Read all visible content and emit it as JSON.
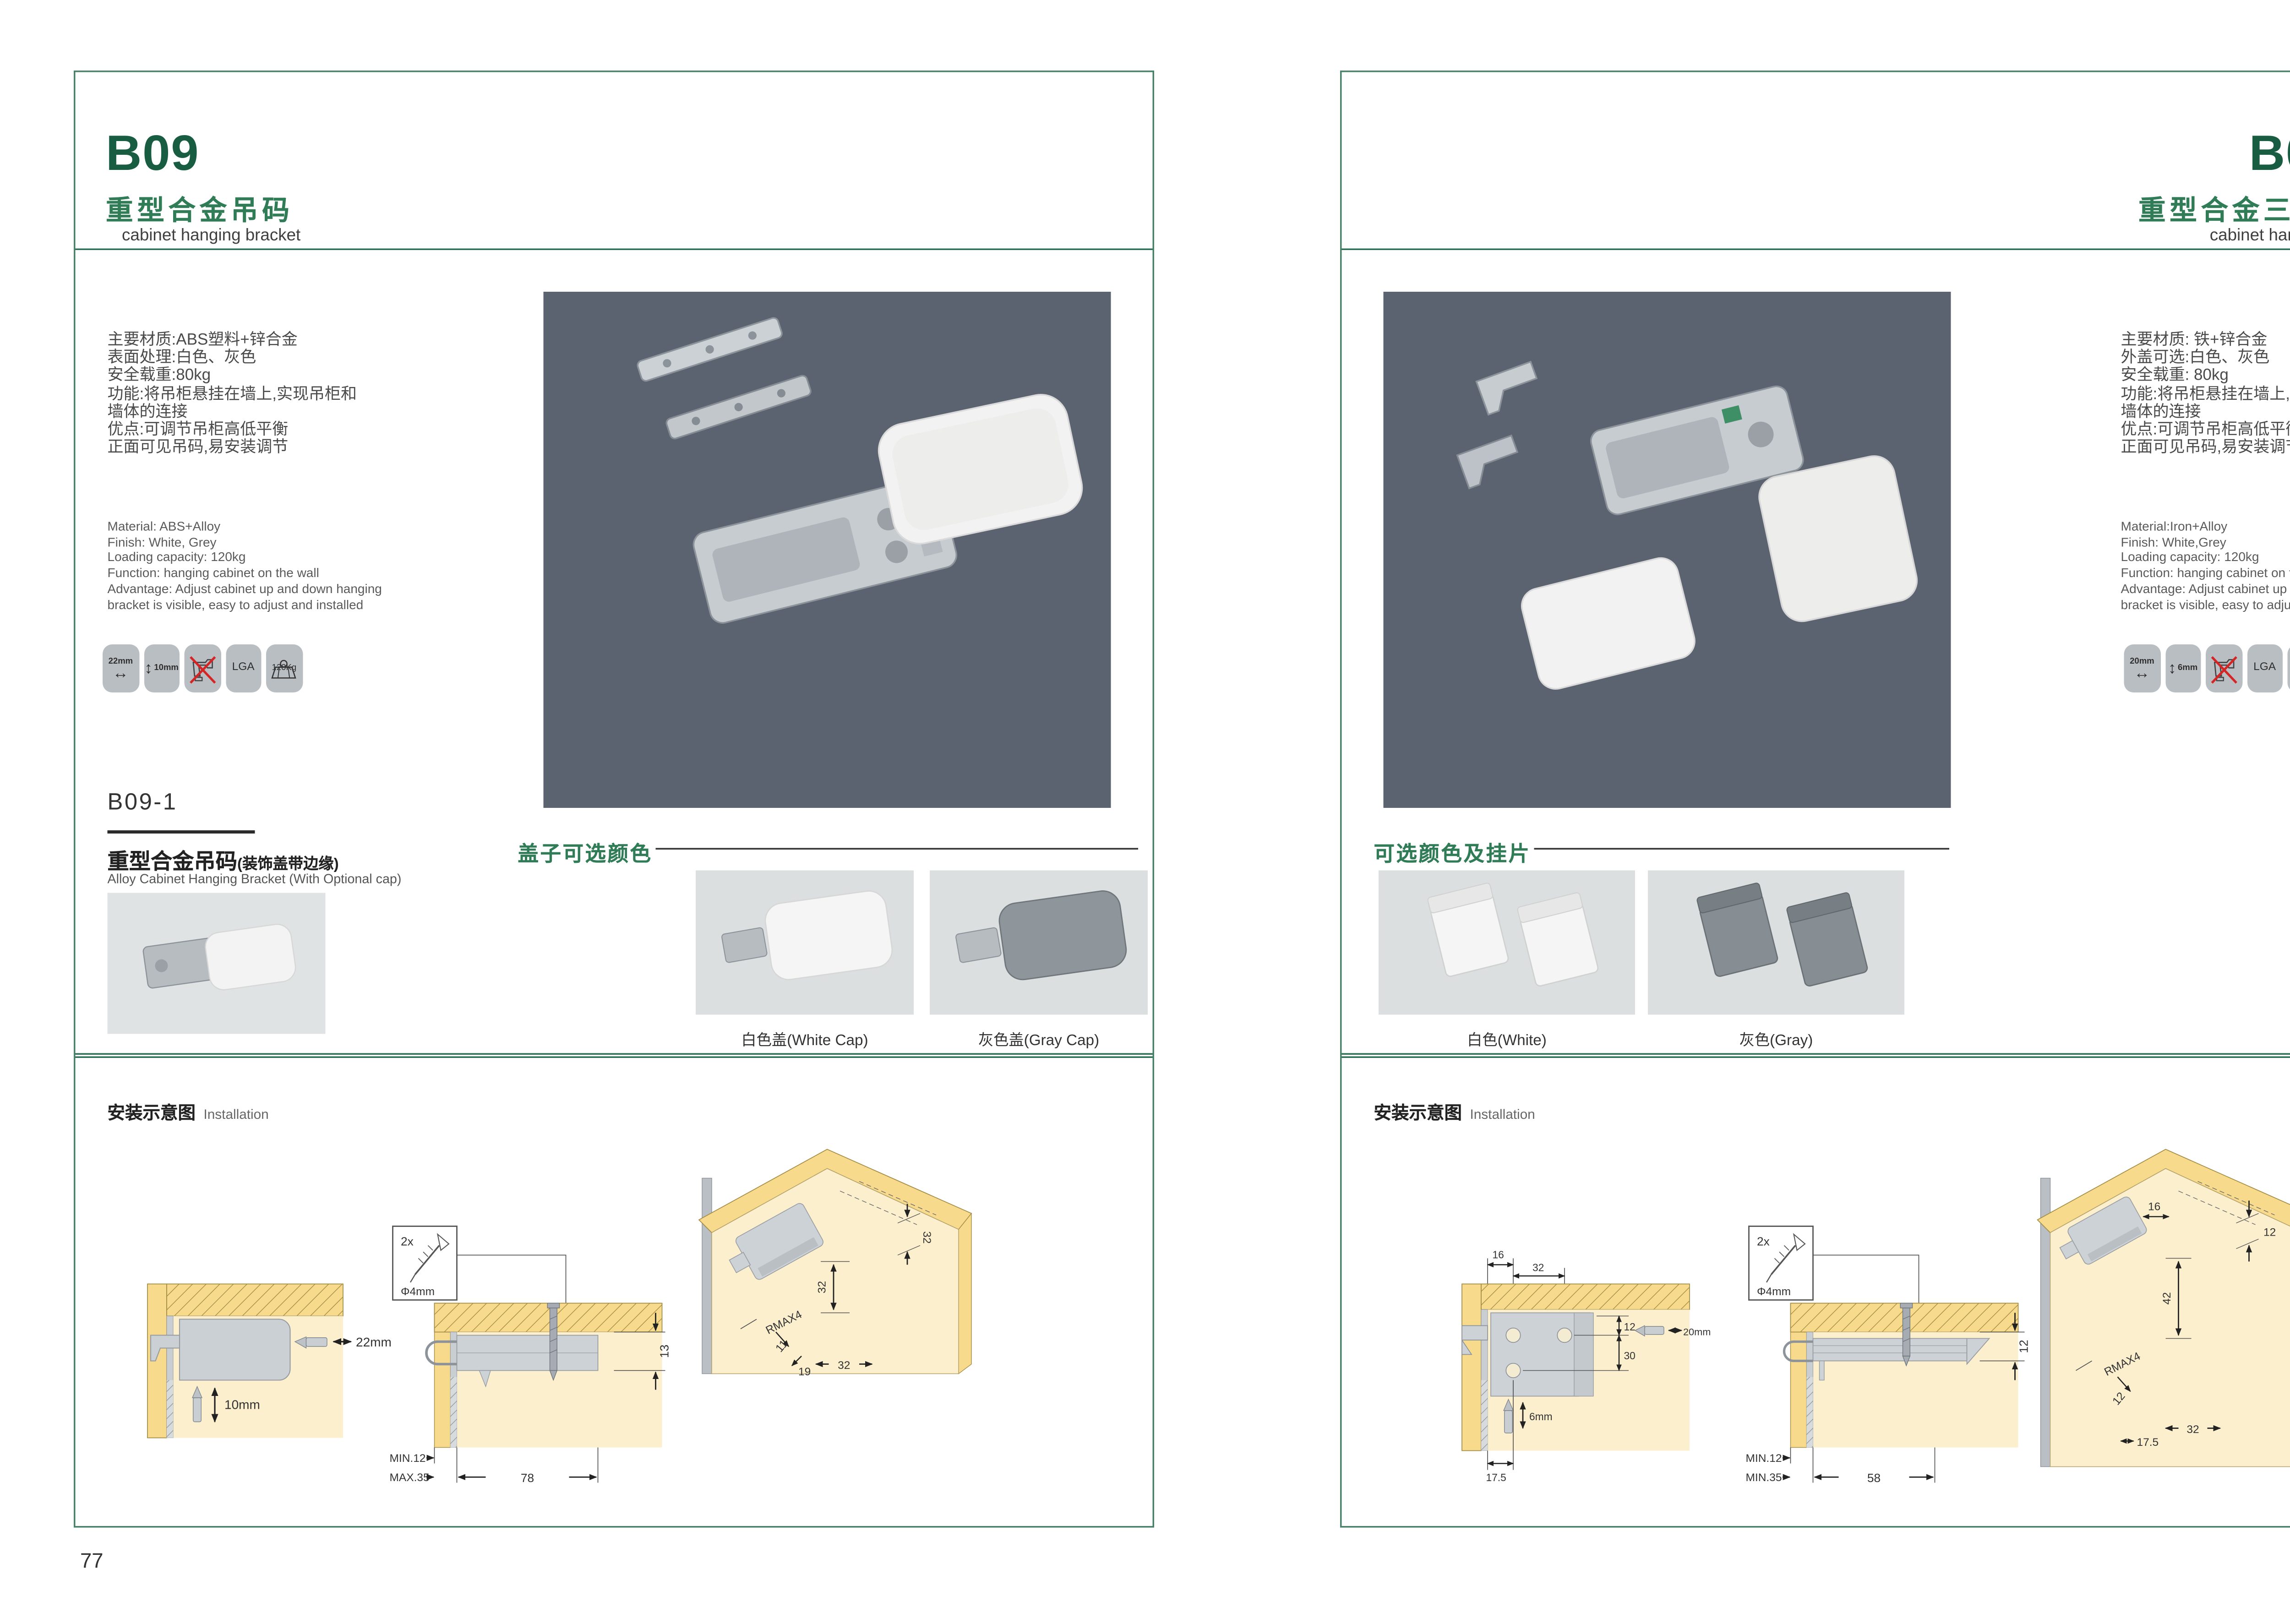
{
  "theme": {
    "brand_green": "#185c41",
    "light_green": "#2f7c57",
    "hero_bg": "#5c6370",
    "wood_yellow": "#f7da8c",
    "panel_cream": "#fcefcd"
  },
  "pages": [
    {
      "code": "B09",
      "title_cn": "重型合金吊码",
      "title_en": "cabinet hanging bracket",
      "specs_cn": [
        "主要材质:ABS塑料+锌合金",
        "表面处理:白色、灰色",
        "安全载重:80kg",
        "功能:将吊柜悬挂在墙上,实现吊柜和",
        "墙体的连接",
        "优点:可调节吊柜高低平衡",
        "正面可见吊码,易安装调节"
      ],
      "specs_en": [
        "Material: ABS+Alloy",
        "Finish: White, Grey",
        "Loading capacity: 120kg",
        "Function: hanging cabinet on the wall",
        "Advantage: Adjust cabinet up and down hanging",
        "bracket is visible, easy to adjust and installed"
      ],
      "icons": {
        "width": "22mm",
        "height": "10mm",
        "cert": "LGA",
        "load": "120Kg"
      },
      "sub": {
        "code": "B09-1",
        "title_cn": "重型合金吊码",
        "title_cn_paren": "(装饰盖带边缘)",
        "title_en": "Alloy Cabinet Hanging Bracket (With Optional cap)"
      },
      "colors": {
        "title": "盖子可选颜色",
        "cap_white": "白色盖(White Cap)",
        "cap_gray": "灰色盖(Gray Cap)"
      },
      "install": {
        "title_cn": "安装示意图",
        "title_en": "Installation",
        "screw_qty": "2x",
        "screw_dia": "Φ4mm",
        "a_h": "22mm",
        "a_v": "10mm",
        "b_side": "13",
        "b_min": "MIN.12",
        "b_max": "MAX.35",
        "b_len": "78",
        "c_top": "32",
        "c_mid": "32",
        "c_r": "RMAX4",
        "c_a": "11",
        "c_b": "19",
        "c_c": "32"
      },
      "page_no": "77"
    },
    {
      "code": "B09-3",
      "title_cn": "重型合金三孔吊码",
      "title_en": "cabinet hanging bracket",
      "specs_cn": [
        "主要材质: 铁+锌合金",
        "外盖可选:白色、灰色",
        "安全载重: 80kg",
        "功能:将吊柜悬挂在墙上,实现吊柜和",
        "墙体的连接",
        "优点:可调节吊柜高低平衡",
        "正面可见吊码,易安装调节"
      ],
      "specs_en": [
        "Material:Iron+Alloy",
        "Finish: White,Grey",
        "Loading capacity: 120kg",
        "Function: hanging cabinet on the wall",
        "Advantage: Adjust cabinet up and down hanging",
        "bracket is visible, easy to adjust and installed"
      ],
      "icons": {
        "width": "20mm",
        "height": "6mm",
        "cert": "LGA",
        "load": "120Kg"
      },
      "colors": {
        "title": "可选颜色及挂片",
        "cap_white": "白色(White)",
        "cap_gray": "灰色(Gray)"
      },
      "install": {
        "title_cn": "安装示意图",
        "title_en": "Installation",
        "screw_qty": "2x",
        "screw_dia": "Φ4mm",
        "a_t1": "16",
        "a_t2": "32",
        "a_r1": "12",
        "a_r2": "30",
        "a_h": "20mm",
        "a_v": "6mm",
        "a_b": "17.5",
        "b_side": "12",
        "b_min": "MIN.12",
        "b_max": "MIN.35",
        "b_len": "58",
        "c_top": "16",
        "c_mid": "42",
        "c_tr": "12",
        "c_r": "RMAX4",
        "c_a": "12",
        "c_b": "17.5",
        "c_c": "32"
      },
      "page_no": "78"
    }
  ]
}
